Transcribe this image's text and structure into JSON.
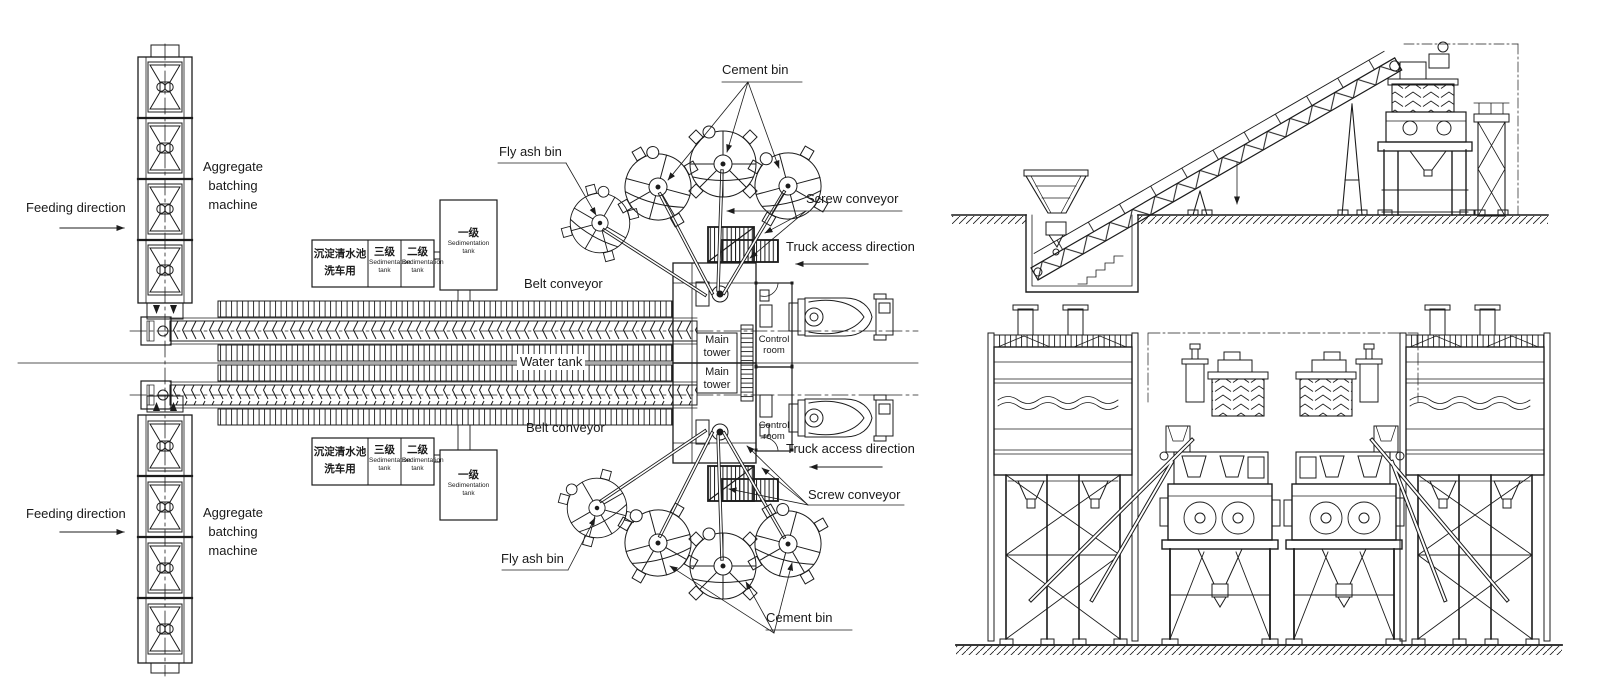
{
  "labels": {
    "feeding_direction": "Feeding direction",
    "aggregate_machine_l1": "Aggregate",
    "aggregate_machine_l2": "batching",
    "aggregate_machine_l3": "machine",
    "cement_bin": "Cement bin",
    "fly_ash_bin": "Fly ash bin",
    "screw_conveyor": "Screw conveyor",
    "truck_access_direction": "Truck access direction",
    "belt_conveyor": "Belt conveyor",
    "water_tank": "Water tank",
    "main_tower_l1": "Main",
    "main_tower_l2": "tower",
    "control_room_l1": "Control",
    "control_room_l2": "room",
    "sed_wash_l1": "沉淀清水池",
    "sed_wash_l2": "洗车用",
    "sed_level3_cn": "三级",
    "sed_level2_cn": "二级",
    "sed_level1_cn": "一级",
    "sed_en_l1": "Sedimentation",
    "sed_en_l2": "tank"
  },
  "colors": {
    "ink": "#1c1c1c",
    "background": "#ffffff"
  }
}
